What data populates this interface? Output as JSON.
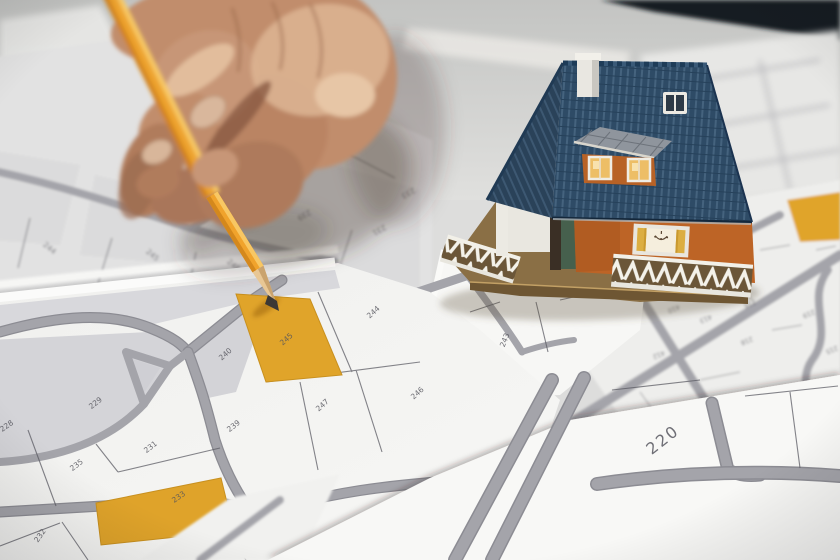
{
  "image": {
    "alt": "Close-up photo: a hand holds a yellow pencil pointing at the orange-highlighted cadastral parcel 245; a miniature model house with a dark blue roof stands on overlapping cadastral map sheets."
  },
  "colors": {
    "desk": "#cfd0cd",
    "dark_edge": "#16191e",
    "paper": "#f5f5f3",
    "road": "#a4a4aa",
    "boundary": "#5c5c64",
    "parcel_tint": "#d4d4d8",
    "highlight": "#e0a42a",
    "pencil": "#efa32c",
    "roof": "#2f4d68",
    "wall": "#bd6426",
    "skin": "#c18d6c"
  },
  "sheets": {
    "under_hand": {
      "parcels": [
        {
          "label": "244"
        },
        {
          "label": "245"
        },
        {
          "label": "248"
        },
        {
          "label": "239"
        },
        {
          "label": "231"
        },
        {
          "label": "233"
        }
      ]
    },
    "main": {
      "parcels": [
        {
          "label": "228"
        },
        {
          "label": "229"
        },
        {
          "label": "235"
        },
        {
          "label": "231"
        },
        {
          "label": "239"
        },
        {
          "label": "240"
        },
        {
          "label": "245",
          "highlighted": true
        },
        {
          "label": "244"
        },
        {
          "label": "247"
        },
        {
          "label": "246"
        },
        {
          "label": "233",
          "highlighted": true
        },
        {
          "label": "232"
        }
      ]
    },
    "near_house": {
      "parcels": [
        {
          "label": "258"
        },
        {
          "label": "243"
        }
      ]
    },
    "right": {
      "parcels": [
        {
          "label": "414"
        },
        {
          "label": "410"
        },
        {
          "label": "413"
        },
        {
          "label": "412"
        },
        {
          "label": "216"
        },
        {
          "label": "219"
        },
        {
          "label": "218"
        },
        {
          "label": "217"
        },
        {
          "label": "215"
        }
      ]
    },
    "foreground": {
      "parcels": [
        {
          "label": "220"
        }
      ]
    }
  }
}
